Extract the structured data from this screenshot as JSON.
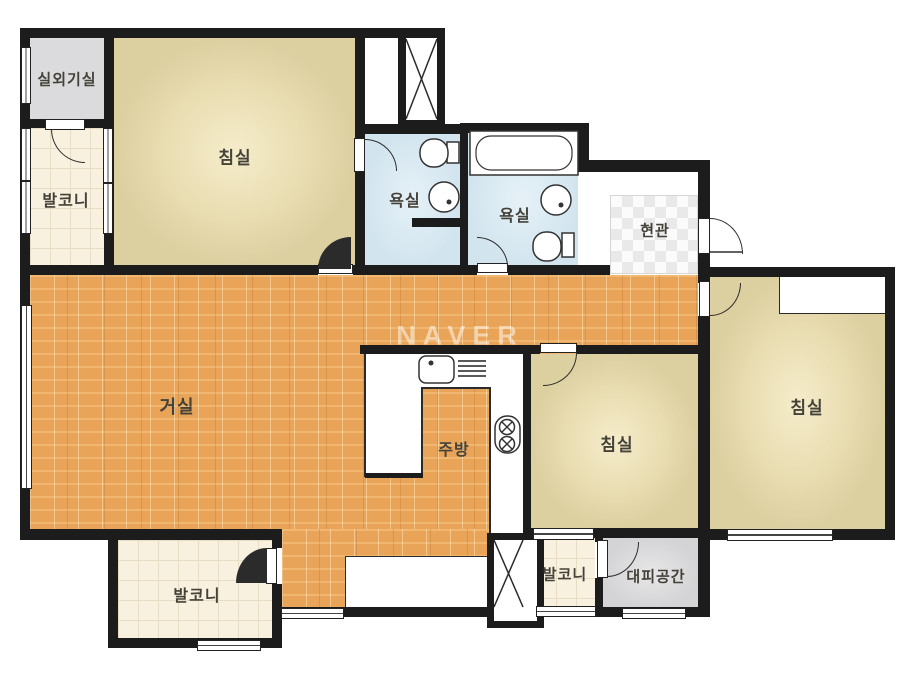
{
  "watermark": "NAVER",
  "rooms": {
    "outdoor_unit_room": {
      "label": "실외기실"
    },
    "balcony_left": {
      "label": "발코니"
    },
    "bedroom_top_left": {
      "label": "침실"
    },
    "bathroom_1": {
      "label": "욕실"
    },
    "bathroom_2": {
      "label": "욕실"
    },
    "entrance": {
      "label": "현관"
    },
    "living_room": {
      "label": "거실"
    },
    "kitchen": {
      "label": "주방"
    },
    "bedroom_middle": {
      "label": "침실"
    },
    "bedroom_right": {
      "label": "침실"
    },
    "balcony_bottom_left": {
      "label": "발코니"
    },
    "balcony_bottom_middle": {
      "label": "발코니"
    },
    "shelter": {
      "label": "대피공간"
    }
  },
  "colors": {
    "wall": "#1c1c1c",
    "wood_floor": "#eaa65b",
    "bedroom_fill": "#e8dcb0",
    "bathroom_fill": "#d7e8f1",
    "balcony_tile": "#f8f1e0",
    "utility_gray": "#dbdbdd",
    "label_text": "#45423a"
  }
}
